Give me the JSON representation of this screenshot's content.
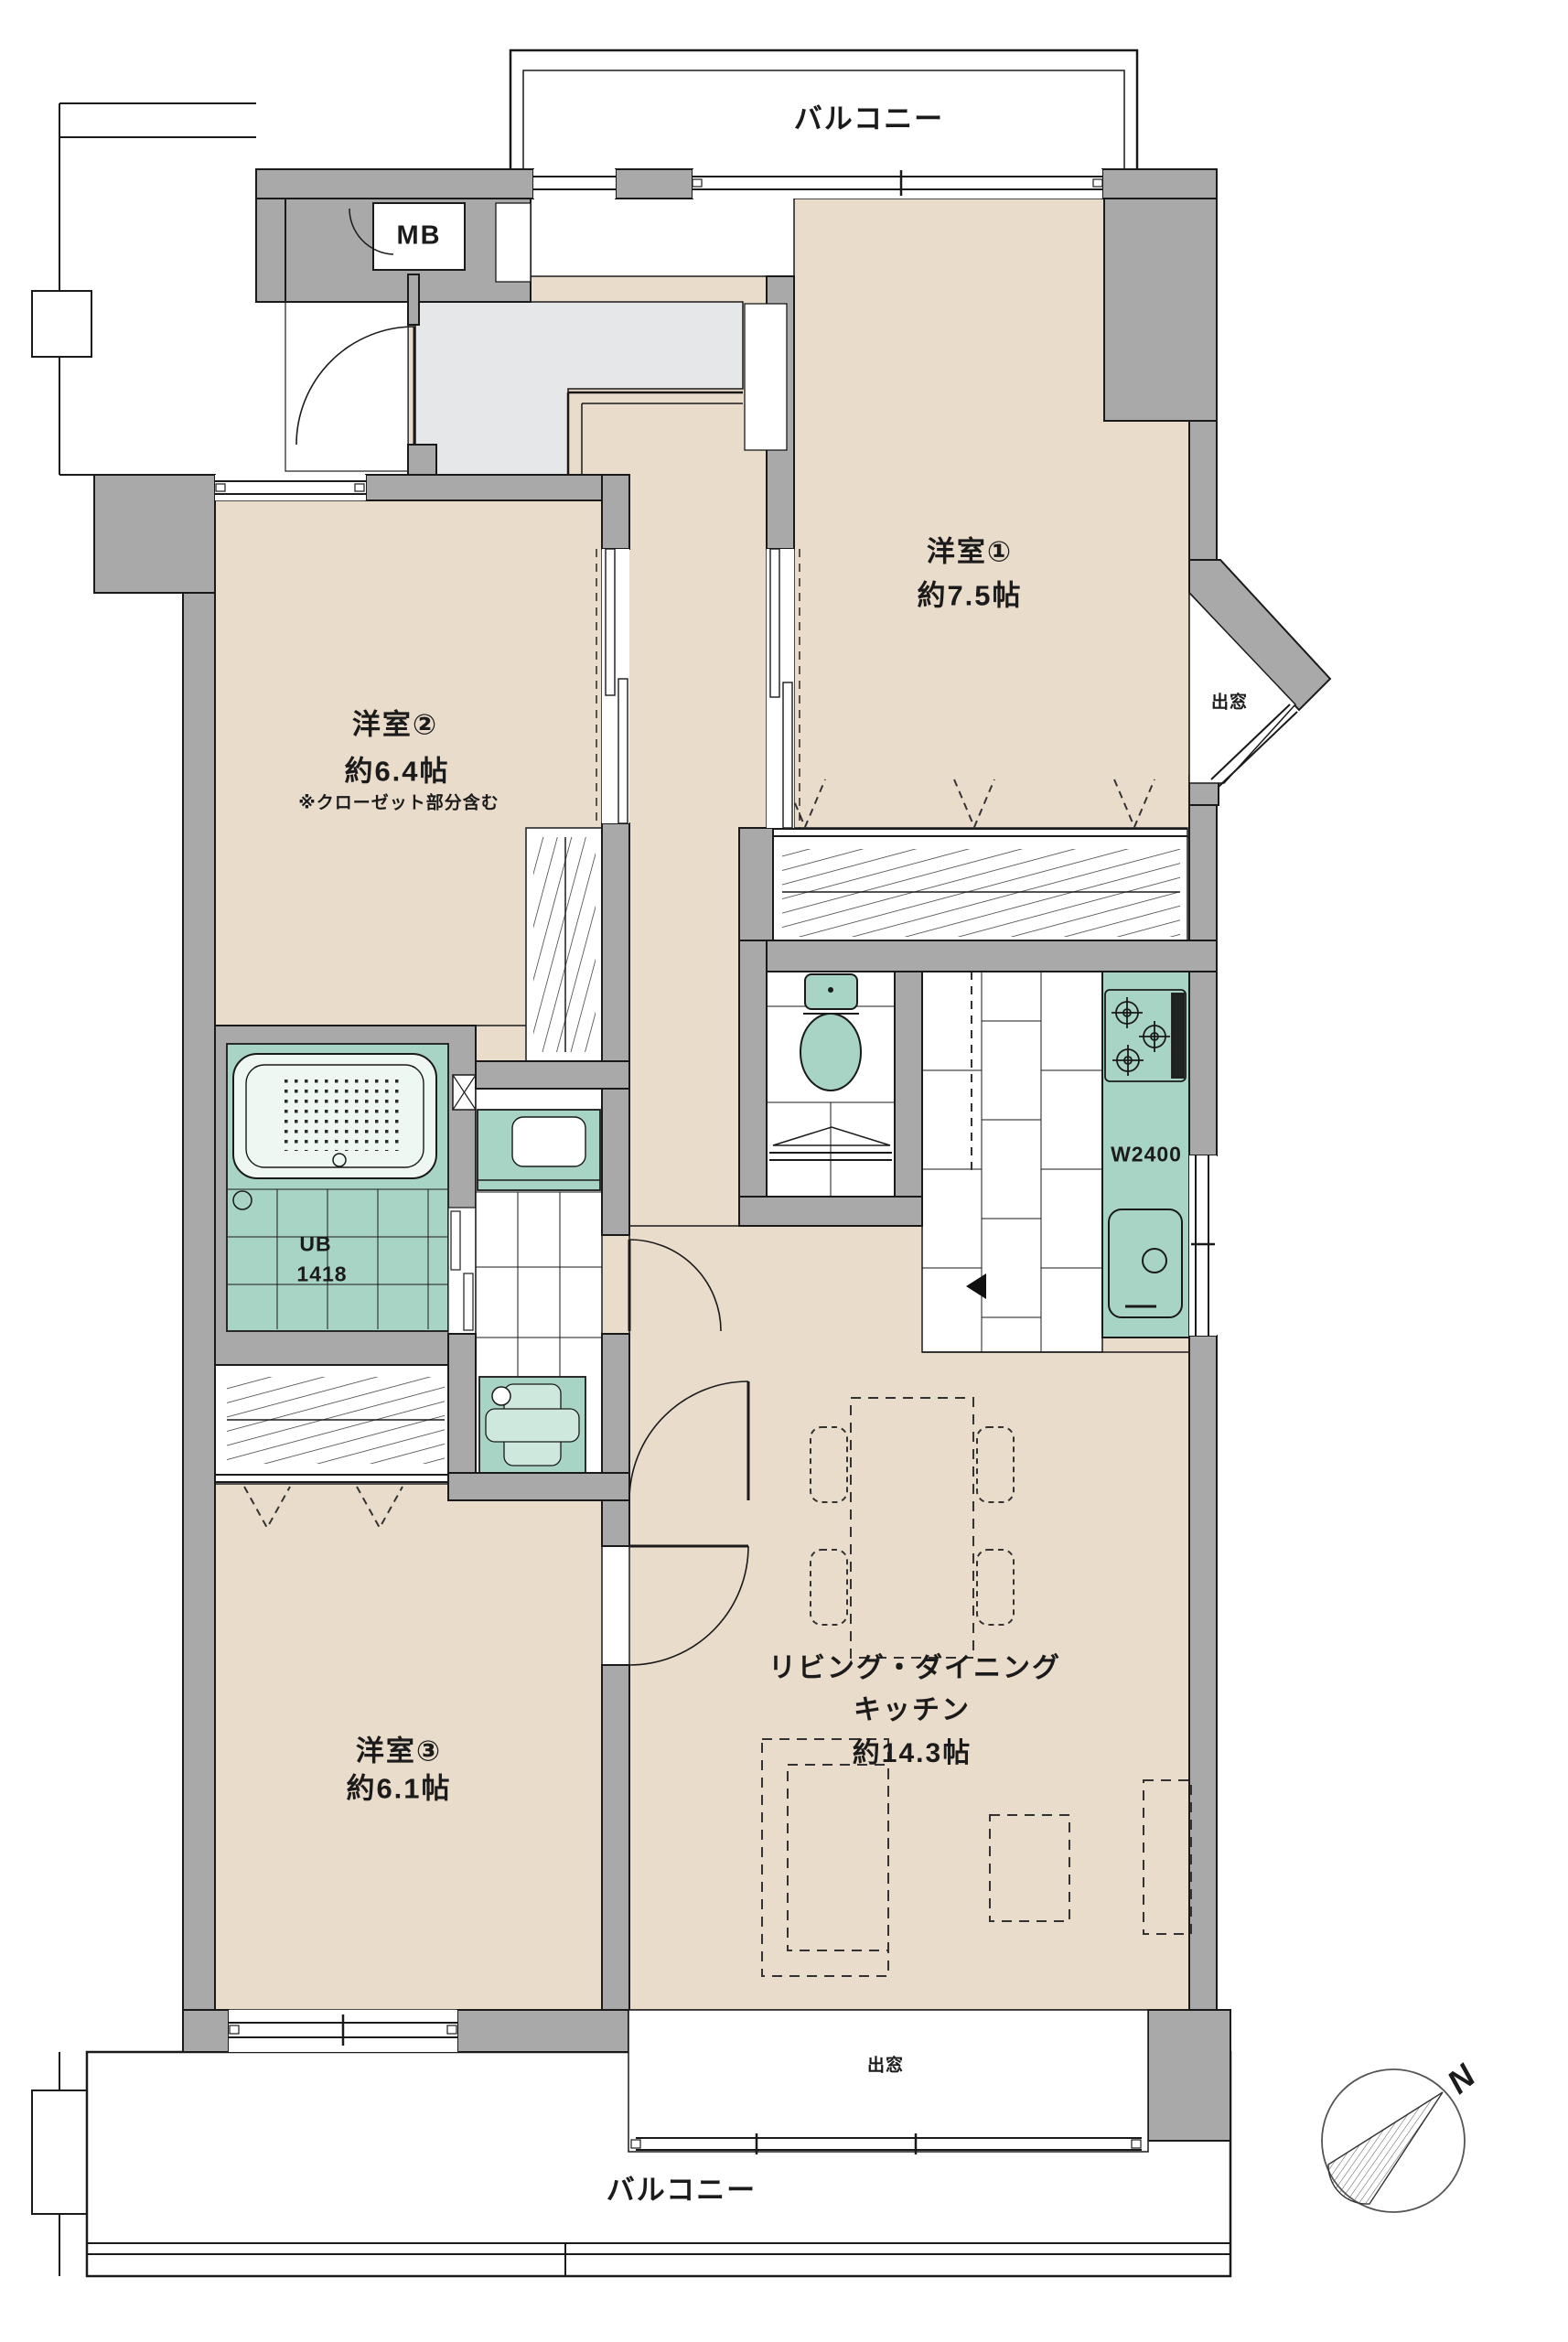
{
  "floorplan": {
    "balconies": {
      "top": "バルコニー",
      "bottom": "バルコニー"
    },
    "meter_box": "MB",
    "rooms": [
      {
        "id": "room1",
        "name": "洋室①",
        "area": "約7.5帖"
      },
      {
        "id": "room2",
        "name": "洋室②",
        "area": "約6.4帖",
        "note": "※クローゼット部分含む"
      },
      {
        "id": "room3",
        "name": "洋室③",
        "area": "約6.1帖"
      },
      {
        "id": "ldk",
        "name_line1": "リビング・ダイニング",
        "name_line2": "キッチン",
        "area": "約14.3帖"
      }
    ],
    "fixtures": {
      "unit_bath_line1": "UB",
      "unit_bath_line2": "1418",
      "kitchen_counter_width": "W2400"
    },
    "bay_windows": {
      "right": "出窓",
      "bottom": "出窓"
    },
    "compass": {
      "north_label": "N"
    },
    "colors": {
      "wall": "#a9a9a9",
      "room_floor": "#e9dccb",
      "entrance_floor": "#e6e7e8",
      "fixture_teal": "#a8d4c6",
      "line": "#1a1a1a"
    }
  }
}
